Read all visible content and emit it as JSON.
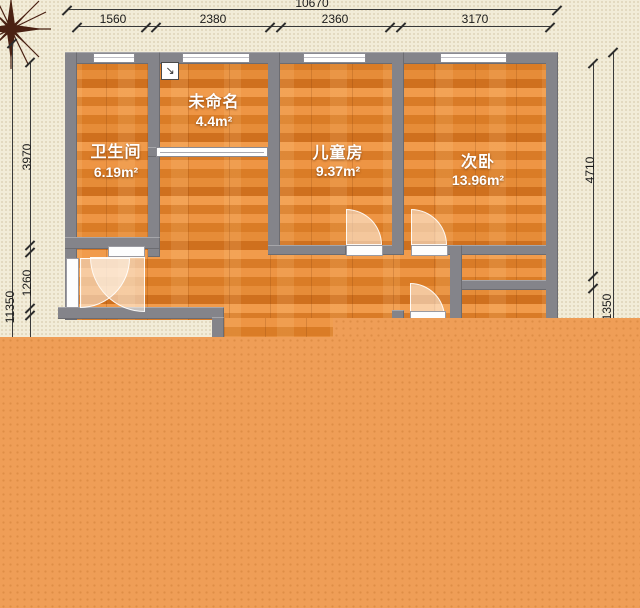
{
  "plan": {
    "type": "floor-plan",
    "rooms": [
      {
        "name": "卫生间",
        "area": "6.19m²"
      },
      {
        "name": "未命名",
        "area": "4.4m²"
      },
      {
        "name": "儿童房",
        "area": "9.37m²"
      },
      {
        "name": "次卧",
        "area": "13.96m²"
      }
    ],
    "dims": {
      "top": {
        "overall": "10670",
        "segments": [
          "1560",
          "2380",
          "2360",
          "3170"
        ]
      },
      "left": {
        "overall": "11350",
        "segments": [
          "3970",
          "1260"
        ]
      },
      "right": {
        "segments": [
          "4710",
          "1350"
        ]
      }
    },
    "icons": {
      "annotation": "↘",
      "compass": "compass-rose"
    },
    "colors": {
      "background": "#f2ecd8",
      "wall": "#84848a",
      "floor": "#e68c38",
      "overlay": "#ef9e57",
      "dimension_text": "#1c1c1c",
      "room_text": "#ffffff"
    }
  }
}
